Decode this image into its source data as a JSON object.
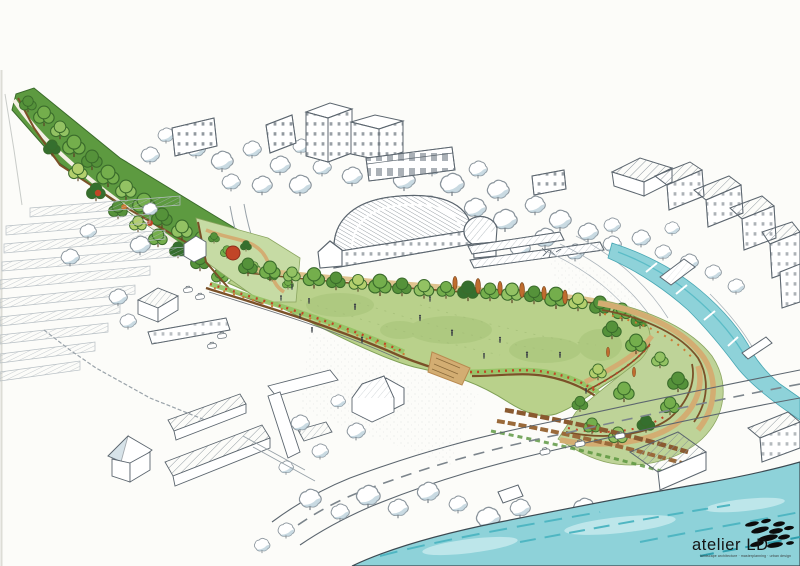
{
  "meta": {
    "description": "Hand-drawn aerial perspective sketch of a riverside park masterplan",
    "style": "pen line work with watercolour marker washes on white paper"
  },
  "logo": {
    "text": "atelier LD",
    "tagline": "landscape architecture · masterplanning · urban design"
  },
  "colors": {
    "paper": "#fcfcf9",
    "ink": "#5c666f",
    "ink-light": "#97a1a8",
    "wash": "#b7cdd8",
    "wash2": "#8fb4c4",
    "lawn": "#b9d18b",
    "lawn2": "#a4c276",
    "green1": "#74ae4c",
    "green2": "#55923a",
    "green3": "#93c263",
    "green4": "#b3cf6d",
    "green5": "#356f2e",
    "tan": "#d3ad72",
    "tan2": "#b98a50",
    "timber": "#7b5128",
    "red": "#c14527",
    "orange": "#cc7a33",
    "river": "#8ed2d9",
    "river2": "#4fb6c2",
    "river3": "#c6eaee",
    "black": "#141414"
  },
  "scene": {
    "regions": [
      "city-context",
      "woodland-belt",
      "car-park",
      "service-yard",
      "leisure-centre",
      "greenhouses",
      "stream",
      "park-lawn",
      "west-garden",
      "tree-promenade",
      "terraced-gardens",
      "farm-buildings",
      "riverside-road",
      "river",
      "logo"
    ]
  }
}
